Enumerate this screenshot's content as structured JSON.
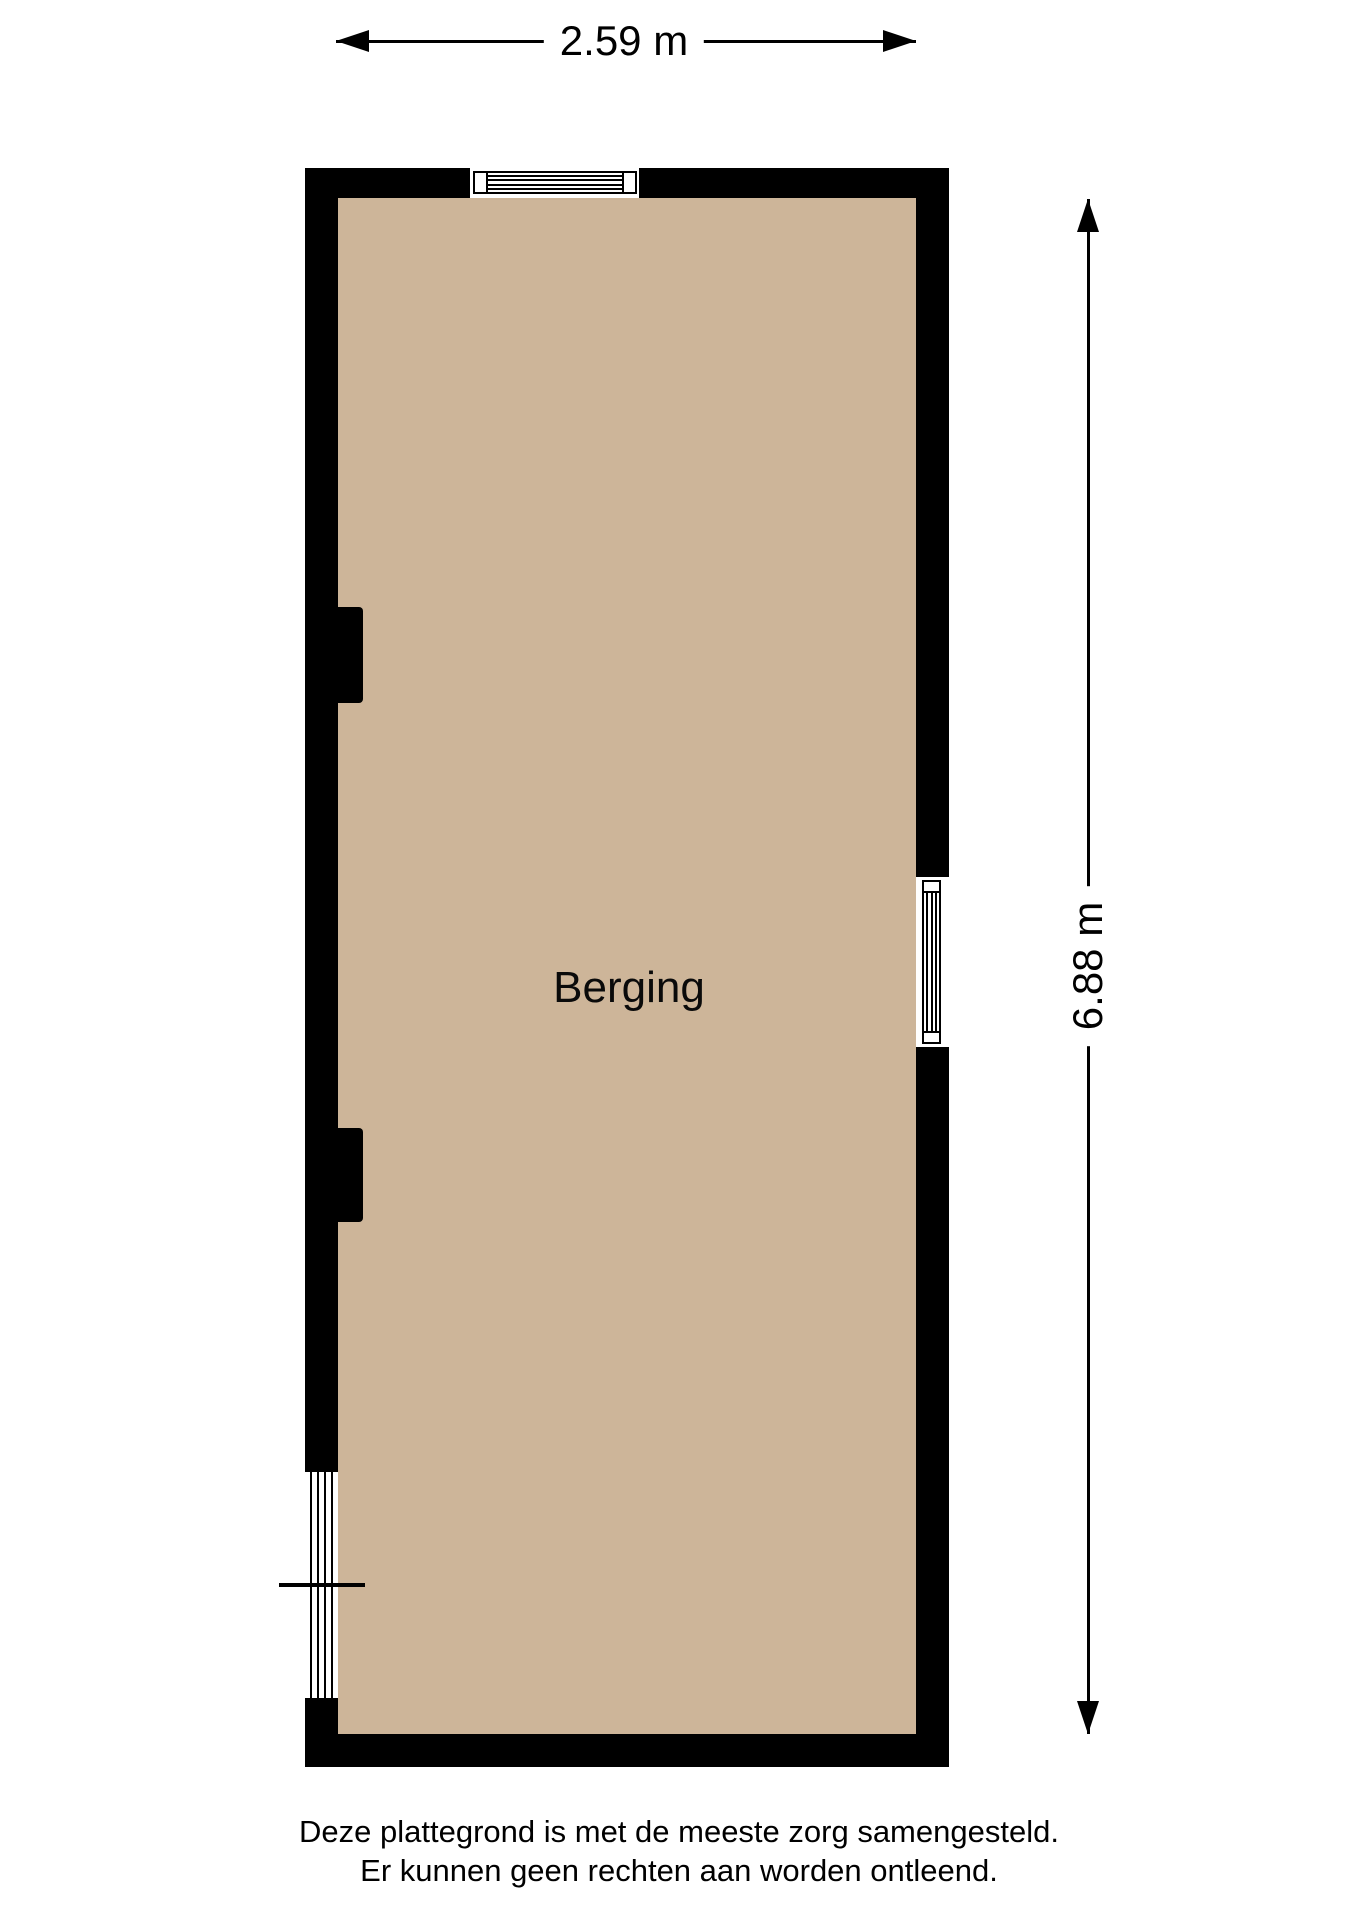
{
  "dimensions": {
    "width_label": "2.59 m",
    "height_label": "6.88 m"
  },
  "room": {
    "label": "Berging"
  },
  "footer": {
    "line1": "Deze plattegrond is met de meeste zorg samengesteld.",
    "line2": "Er kunnen geen rechten aan worden ontleend."
  },
  "colors": {
    "floor": "#CDB599",
    "wall": "#000000",
    "line": "#000000",
    "background": "#FFFFFF"
  }
}
